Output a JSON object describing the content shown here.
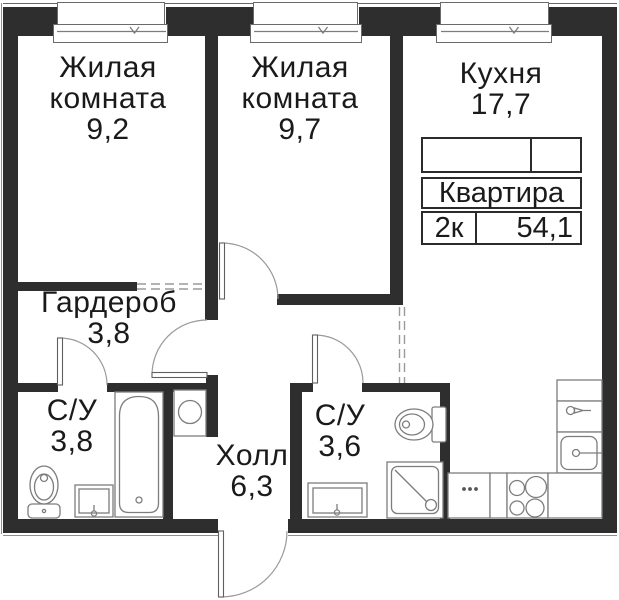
{
  "plan": {
    "title": "2-room apartment floor plan",
    "colors": {
      "wall": "#2e2e2e",
      "line": "#8a8a8a",
      "text": "#1a1a1a",
      "bg": "#ffffff",
      "tborder": "#2b2b2b"
    }
  },
  "rooms": {
    "living1": {
      "line1": "Жилая",
      "line2": "комната",
      "area": "9,2"
    },
    "living2": {
      "line1": "Жилая",
      "line2": "комната",
      "area": "9,7"
    },
    "kitchen": {
      "line1": "Кухня",
      "area": "17,7"
    },
    "wardrobe": {
      "line1": "Гардероб",
      "area": "3,8"
    },
    "bath_1": {
      "line1": "С/У",
      "area": "3,8"
    },
    "hall": {
      "line1": "Холл",
      "area": "6,3"
    },
    "bath_2": {
      "line1": "С/У",
      "area": "3,6"
    }
  },
  "info_table": {
    "title": "Квартира",
    "rooms_label": "2к",
    "total_area": "54,1"
  },
  "fixtures": {
    "bath_1": [
      "toilet",
      "sink",
      "bathtub"
    ],
    "laundry_niche": [
      "washing-machine"
    ],
    "bath_2": [
      "toilet",
      "sink",
      "shower"
    ],
    "kitchen": [
      "counter",
      "faucet",
      "kitchen-sink",
      "cooktop-switch",
      "stove"
    ]
  }
}
